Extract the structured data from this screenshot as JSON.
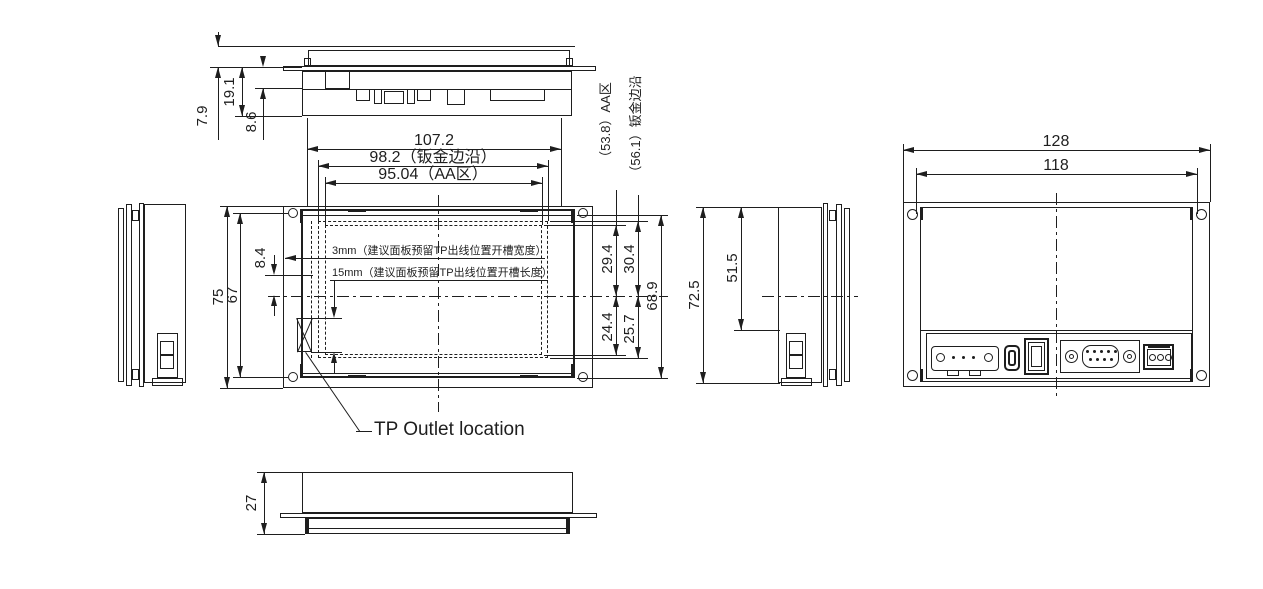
{
  "views": {
    "top": {
      "dims": {
        "surface_to_flange": "7.9",
        "flange_to_bottom": "19.1",
        "flange_to_pcb": "8.6"
      }
    },
    "front": {
      "dims": {
        "overall_width": "107.2",
        "sheet_width": "98.2（钣金边沿）",
        "aa_width": "95.04（AA区）",
        "overall_height": "75",
        "hole_spacing": "67",
        "slot_offset": "8.4",
        "aa_above": "29.4",
        "sheet_above": "30.4",
        "aa_below": "24.4",
        "sheet_below": "25.7",
        "body_height": "68.9",
        "aa_height_callout": "（53.8）AA区",
        "sheet_height_callout": "（56.1）钣金边沿"
      },
      "notes": {
        "slot_width_note": "3mm（建议面板预留TP出线位置开槽宽度）",
        "slot_length_note": "15mm（建议面板预留TP出线位置开槽长度）",
        "tp_outlet_label": "TP Outlet location"
      }
    },
    "side": {
      "dims": {
        "overall_height": "72.5",
        "cover_height": "51.5"
      }
    },
    "back": {
      "dims": {
        "overall_width": "128",
        "hole_spacing": "118"
      }
    },
    "bottom": {
      "dims": {
        "depth": "27"
      }
    }
  }
}
